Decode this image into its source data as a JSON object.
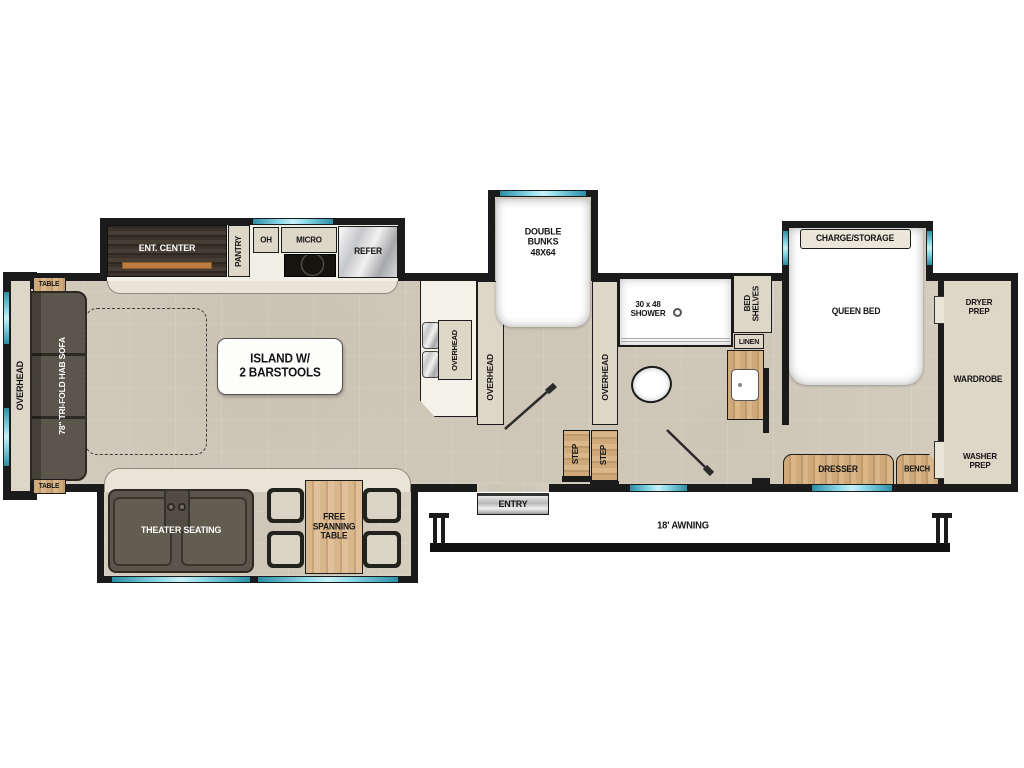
{
  "title": "Fifth Wheel RV Floor Plan",
  "colors": {
    "window_accent": "#49b6cf",
    "wall": "#1b1b1b",
    "floor": "#d7d0c2",
    "wood": "#cba87a",
    "dark_wood": "#362f28",
    "sofa": "#5a564b",
    "white_furniture": "#ffffff"
  },
  "kitchen_slide": {
    "ent_center": "ENT. CENTER",
    "pantry": "PANTRY",
    "oh": "OH",
    "micro": "MICRO",
    "refer": "REFER"
  },
  "living": {
    "overhead": "OVERHEAD",
    "table_front": "TABLE",
    "table_rear": "TABLE",
    "sofa": "78\" TRI-FOLD HAB SOFA",
    "island": "ISLAND W/\n2 BARSTOOLS",
    "counter_overhead": "OVERHEAD"
  },
  "bunk_room": {
    "bunks": "DOUBLE\nBUNKS\n48X64",
    "overhead_left": "OVERHEAD",
    "overhead_right": "OVERHEAD",
    "step1": "STEP",
    "step2": "STEP"
  },
  "bathroom": {
    "shower": "30 x 48\nSHOWER",
    "bed_shelves": "BED\nSHELVES",
    "linen": "LINEN"
  },
  "bedroom": {
    "charge_storage": "CHARGE/STORAGE",
    "queen_bed": "QUEEN BED",
    "dresser": "DRESSER",
    "bench": "BENCH"
  },
  "front_closet": {
    "dryer_prep": "DRYER\nPREP",
    "wardrobe": "WARDROBE",
    "washer_prep": "WASHER\nPREP"
  },
  "lower_slide": {
    "theater": "THEATER SEATING",
    "free_table": "FREE\nSPANNING\nTABLE"
  },
  "exterior": {
    "entry": "ENTRY",
    "awning": "18' AWNING"
  }
}
